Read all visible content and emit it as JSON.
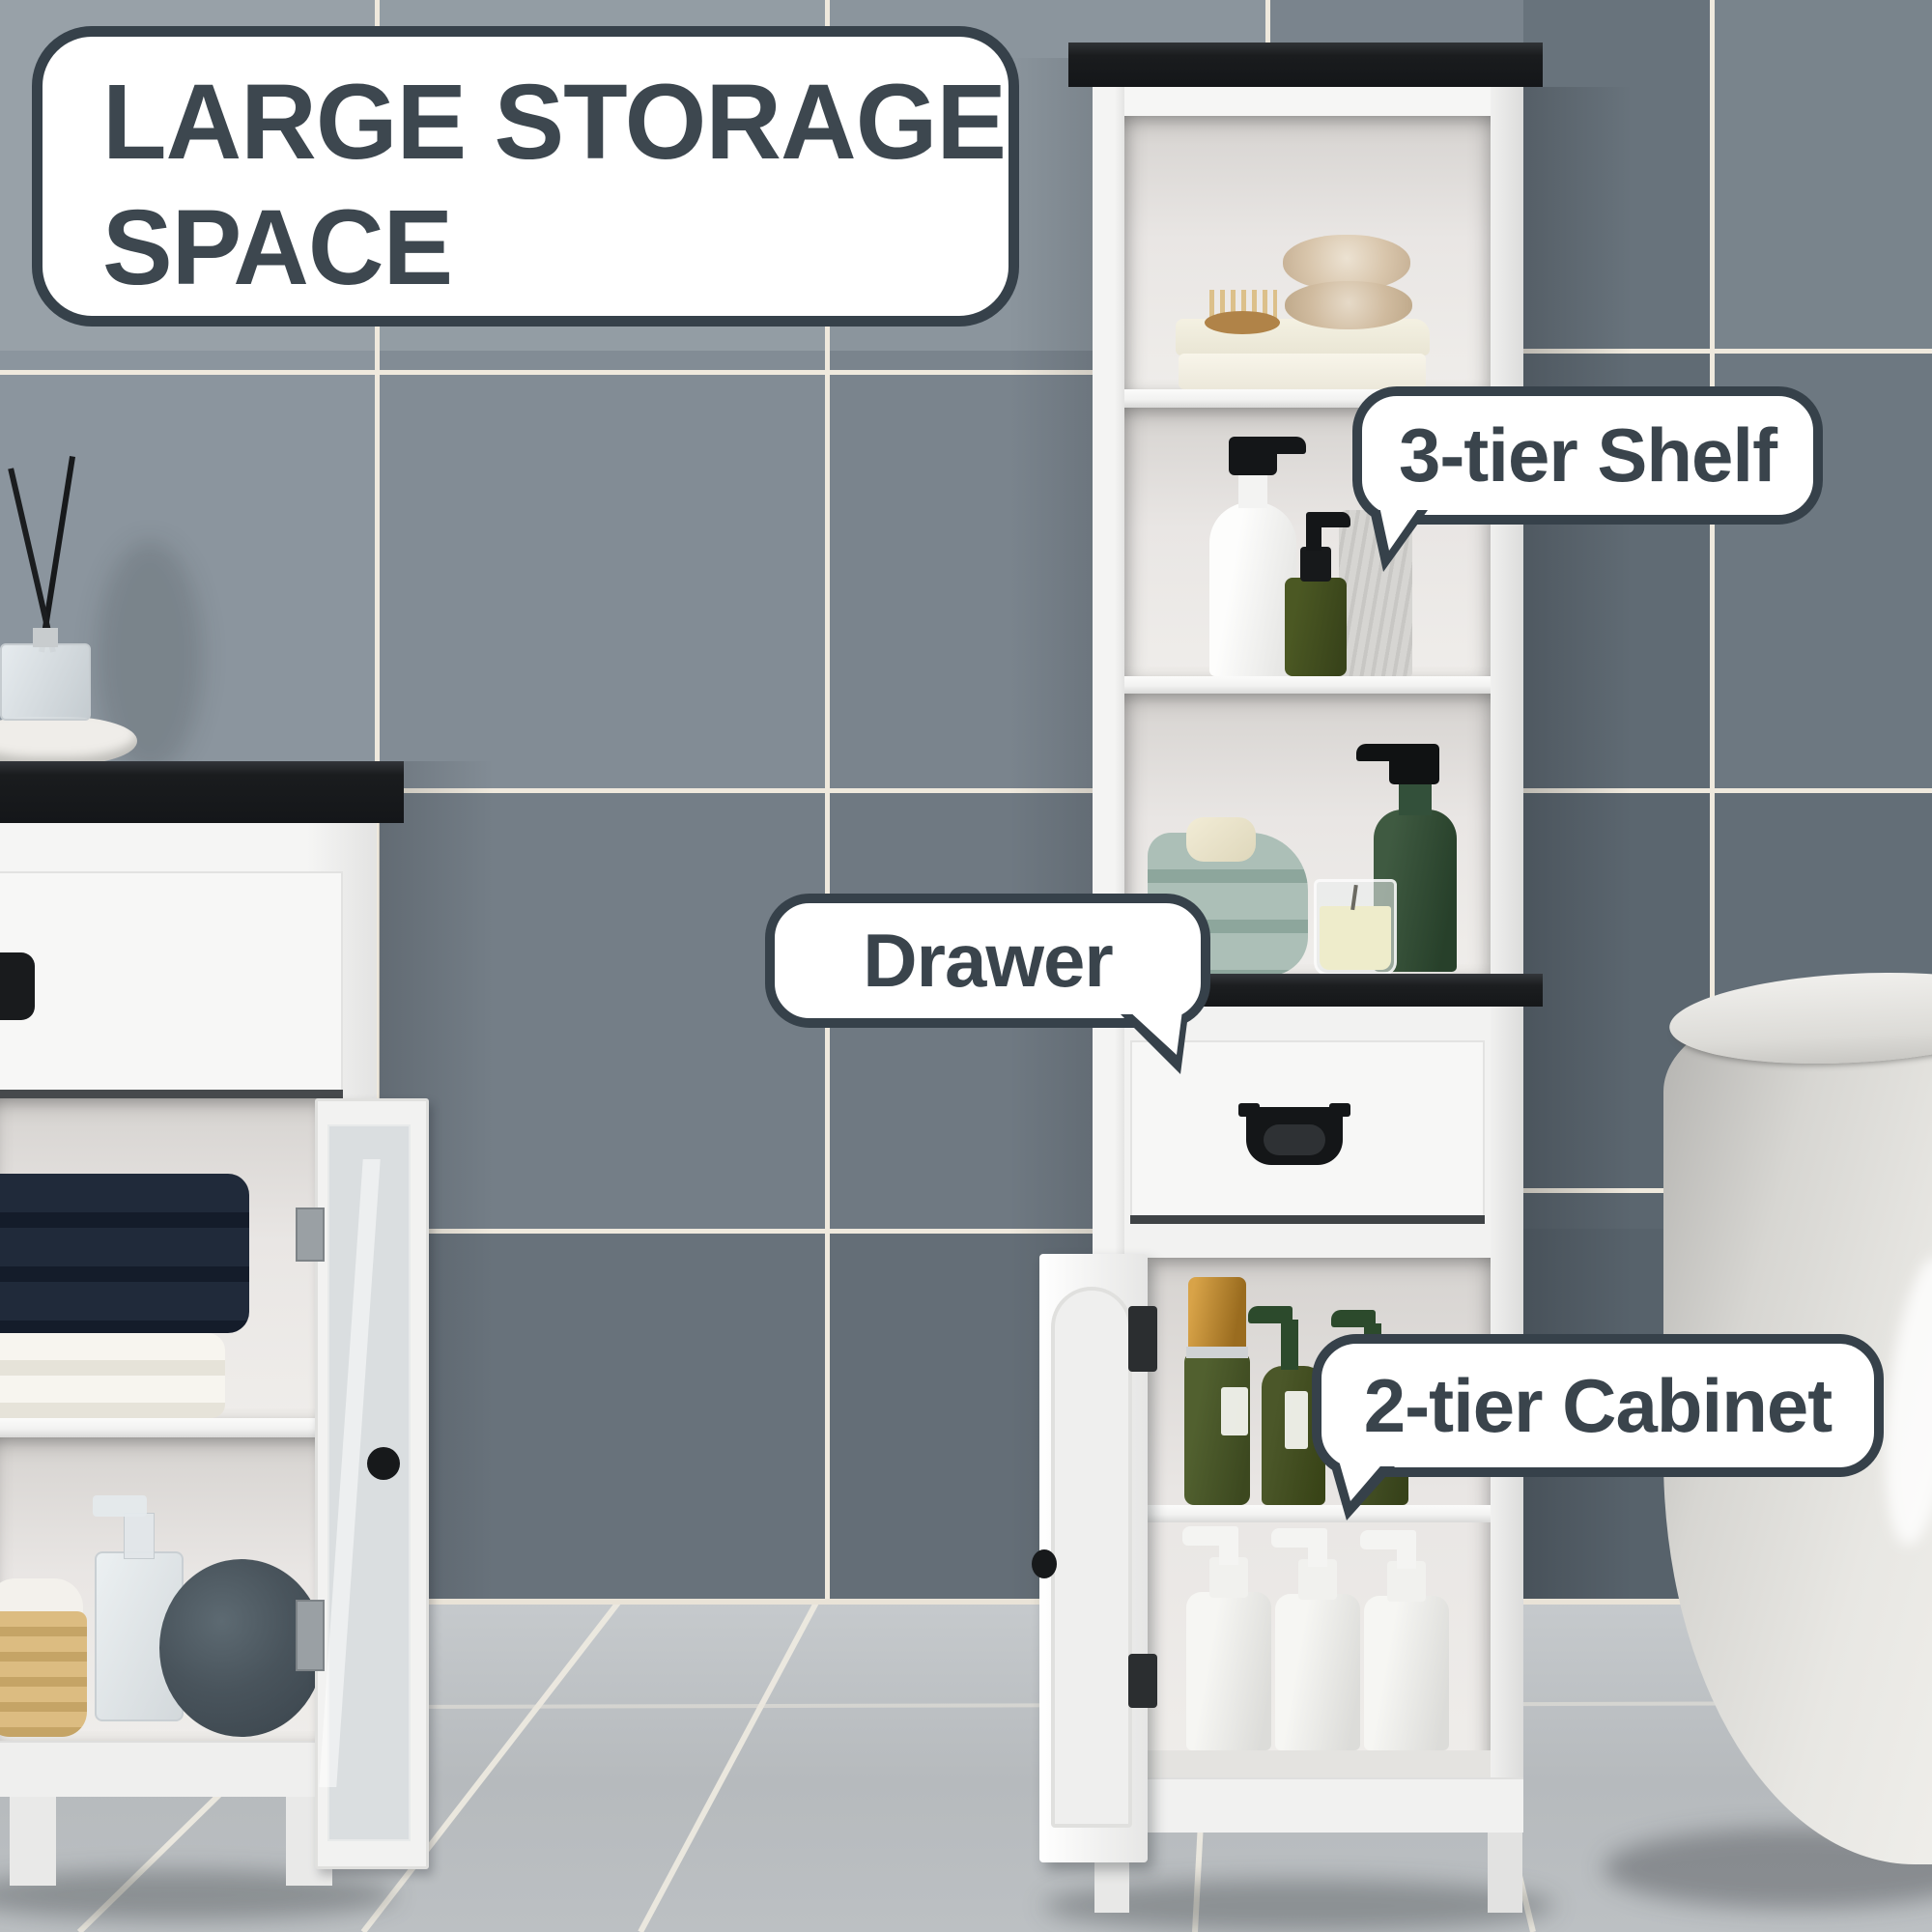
{
  "title": {
    "line1": "LARGE STORAGE",
    "line2": "SPACE"
  },
  "callouts": {
    "shelf_label": "3-tier Shelf",
    "drawer_label": "Drawer",
    "cabinet_label": "2-tier Cabinet"
  },
  "colors": {
    "callout_border": "#36414a",
    "callout_text": "#3a444c",
    "callout_bg": "#ffffff",
    "title_text": "#3d474f",
    "wall_tile_light": "#98a1a8",
    "wall_tile_dark": "#57626b",
    "grout": "#efe9dd",
    "floor": "#bfc3c6",
    "furniture_white": "#f4f4f3",
    "counter_black": "#17181a",
    "towel_teal": "#a3b8b0",
    "towel_navy": "#1c2533",
    "bottle_olive": "#46522c",
    "cap_gold": "#c08a31"
  }
}
